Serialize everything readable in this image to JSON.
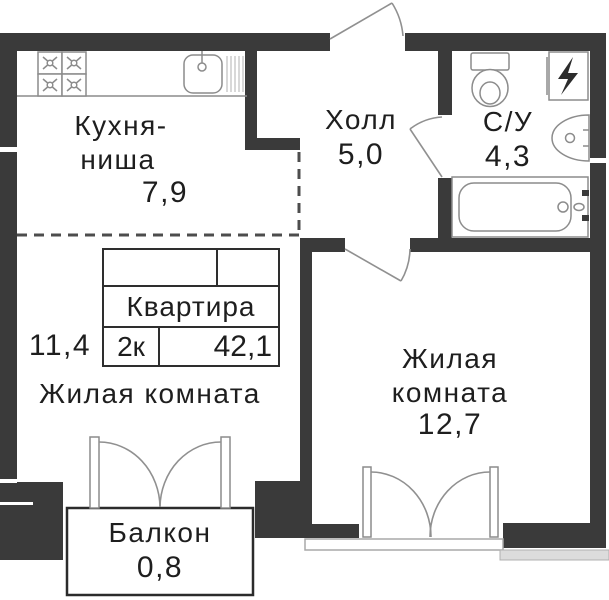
{
  "plan_type": "apartment-floor-plan",
  "apartment_card": {
    "title": "Квартира",
    "rooms_code": "2к",
    "total_area": "42,1"
  },
  "rooms": {
    "kitchen": {
      "name_line1": "Кухня-",
      "name_line2": "ниша",
      "area": "7,9"
    },
    "hall": {
      "name": "Холл",
      "area": "5,0"
    },
    "bathroom": {
      "name": "С/У",
      "area": "4,3"
    },
    "living_room_1": {
      "name": "Жилая комната",
      "area": "11,4"
    },
    "living_room_2": {
      "name_line1": "Жилая",
      "name_line2": "комната",
      "area": "12,7"
    },
    "balcony": {
      "name": "Балкон",
      "area": "0,8"
    }
  },
  "fixtures": [
    "stove-4-burners",
    "kitchen-sink",
    "drainboard",
    "toilet",
    "electric-panel",
    "washbasin",
    "bathtub",
    "entrance-door",
    "room-door",
    "bathroom-door",
    "balcony-french-door",
    "living-room-french-window"
  ],
  "colors": {
    "wall": "#3a3a3a",
    "line": "#8c8c8c",
    "outline": "#2b2b2b",
    "text": "#1e1e1e"
  }
}
